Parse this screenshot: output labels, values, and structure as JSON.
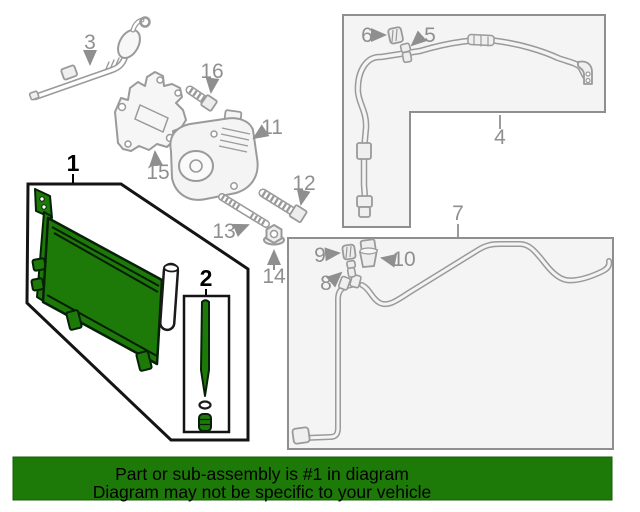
{
  "diagram": {
    "type": "auto-parts-exploded-diagram",
    "subject": "A/C condenser and lines illustration",
    "callouts": [
      {
        "number": "1",
        "highlighted": true
      },
      {
        "number": "2",
        "highlighted": true
      },
      {
        "number": "3",
        "highlighted": false
      },
      {
        "number": "4",
        "highlighted": false
      },
      {
        "number": "5",
        "highlighted": false
      },
      {
        "number": "6",
        "highlighted": false
      },
      {
        "number": "7",
        "highlighted": false
      },
      {
        "number": "8",
        "highlighted": false
      },
      {
        "number": "9",
        "highlighted": false
      },
      {
        "number": "10",
        "highlighted": false
      },
      {
        "number": "11",
        "highlighted": false
      },
      {
        "number": "12",
        "highlighted": false
      },
      {
        "number": "13",
        "highlighted": false
      },
      {
        "number": "14",
        "highlighted": false
      },
      {
        "number": "15",
        "highlighted": false
      },
      {
        "number": "16",
        "highlighted": false
      }
    ]
  },
  "banner": {
    "line1": "Part or sub-assembly is #1 in diagram",
    "line2": "Diagram may not be specific to your vehicle",
    "background_color": "#1e7a08",
    "text_color": "#000000"
  },
  "colors": {
    "highlight_green": "#1e7a08",
    "line_gray": "#9a9a9a",
    "label_gray": "#8f8f8f",
    "outline_black": "#141414",
    "box_fill": "#f4f4f4"
  }
}
